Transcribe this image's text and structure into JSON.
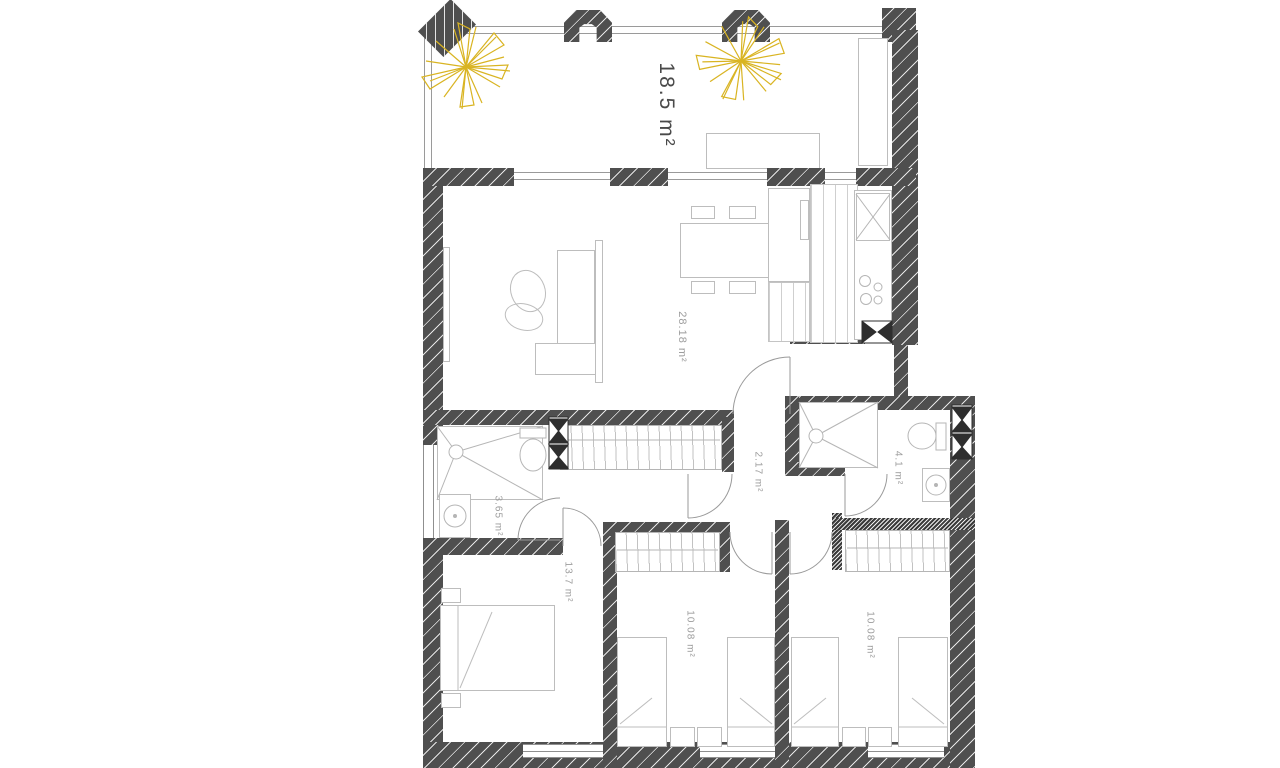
{
  "plan": {
    "rooms": {
      "terrace": {
        "area_label": "18.5 m²"
      },
      "living_kitchen": {
        "area_label": "28.18 m²"
      },
      "bathroom_main": {
        "area_label": "3.65 m²"
      },
      "hallway": {
        "area_label": "2.17 m²"
      },
      "bathroom_small": {
        "area_label": "4.1 m²"
      },
      "bedroom_master": {
        "area_label": "13.7 m²"
      },
      "bedroom_two": {
        "area_label": "10.08 m²"
      },
      "bedroom_three": {
        "area_label": "10.08 m²"
      }
    },
    "colors": {
      "wall": "#4f4f4f",
      "furniture_outline": "#bdbdbd",
      "label": "#9d9d9d",
      "label_dark": "#4a4a4a",
      "plant_accent": "#d9b422"
    },
    "icons": [
      "plant-icon",
      "shower-icon",
      "toilet-icon",
      "sink-icon",
      "hob-icon",
      "duct-icon",
      "door-swing-icon",
      "bed-icon",
      "wardrobe-icon"
    ]
  }
}
